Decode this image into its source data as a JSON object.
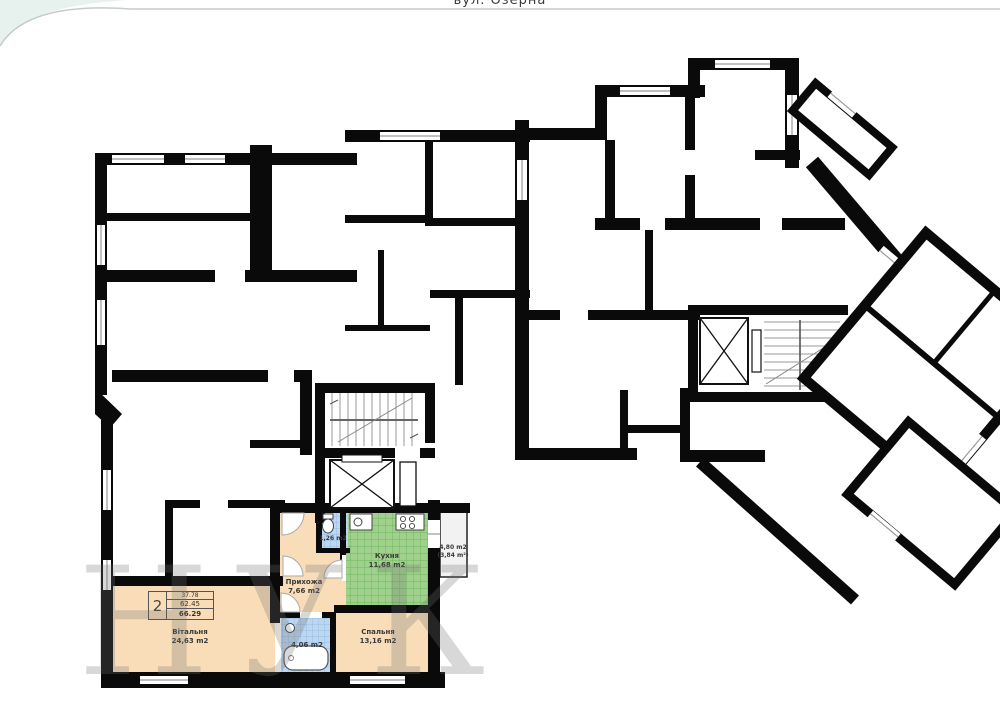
{
  "page": {
    "street_label": "вул. Озерна",
    "chrome_teal": "#e7f2ef",
    "chrome_line": "#c3cccb"
  },
  "stamp": {
    "rooms_count": "2",
    "living_area": "37.78",
    "apartment_area": "62.45",
    "total_area": "66.29"
  },
  "apartment": {
    "hall": {
      "name": "Прихожа",
      "area": "7,66 m2"
    },
    "kitchen": {
      "name": "Кухня",
      "area": "11,68 m2"
    },
    "wc": {
      "area": "1,26 m2"
    },
    "bathroom": {
      "area": "4,06 m2"
    },
    "living": {
      "name": "Вітальня",
      "area": "24,63 m2"
    },
    "bedroom": {
      "name": "Спальня",
      "area": "13,16 m2"
    },
    "balcony": {
      "area": "4,80 m2",
      "area_reduced": "(3,84 m²)"
    }
  },
  "watermark": "НУК",
  "colors": {
    "wall": "#0a0a0a",
    "room_fill": "#f8ddb8",
    "kitchen_fill": "#9fd18c",
    "kitchen_grid": "#6db55e",
    "tile_fill": "#bcd7f2",
    "tile_grid": "#8fb6dd",
    "balcony_fill": "#f2f2f2"
  }
}
